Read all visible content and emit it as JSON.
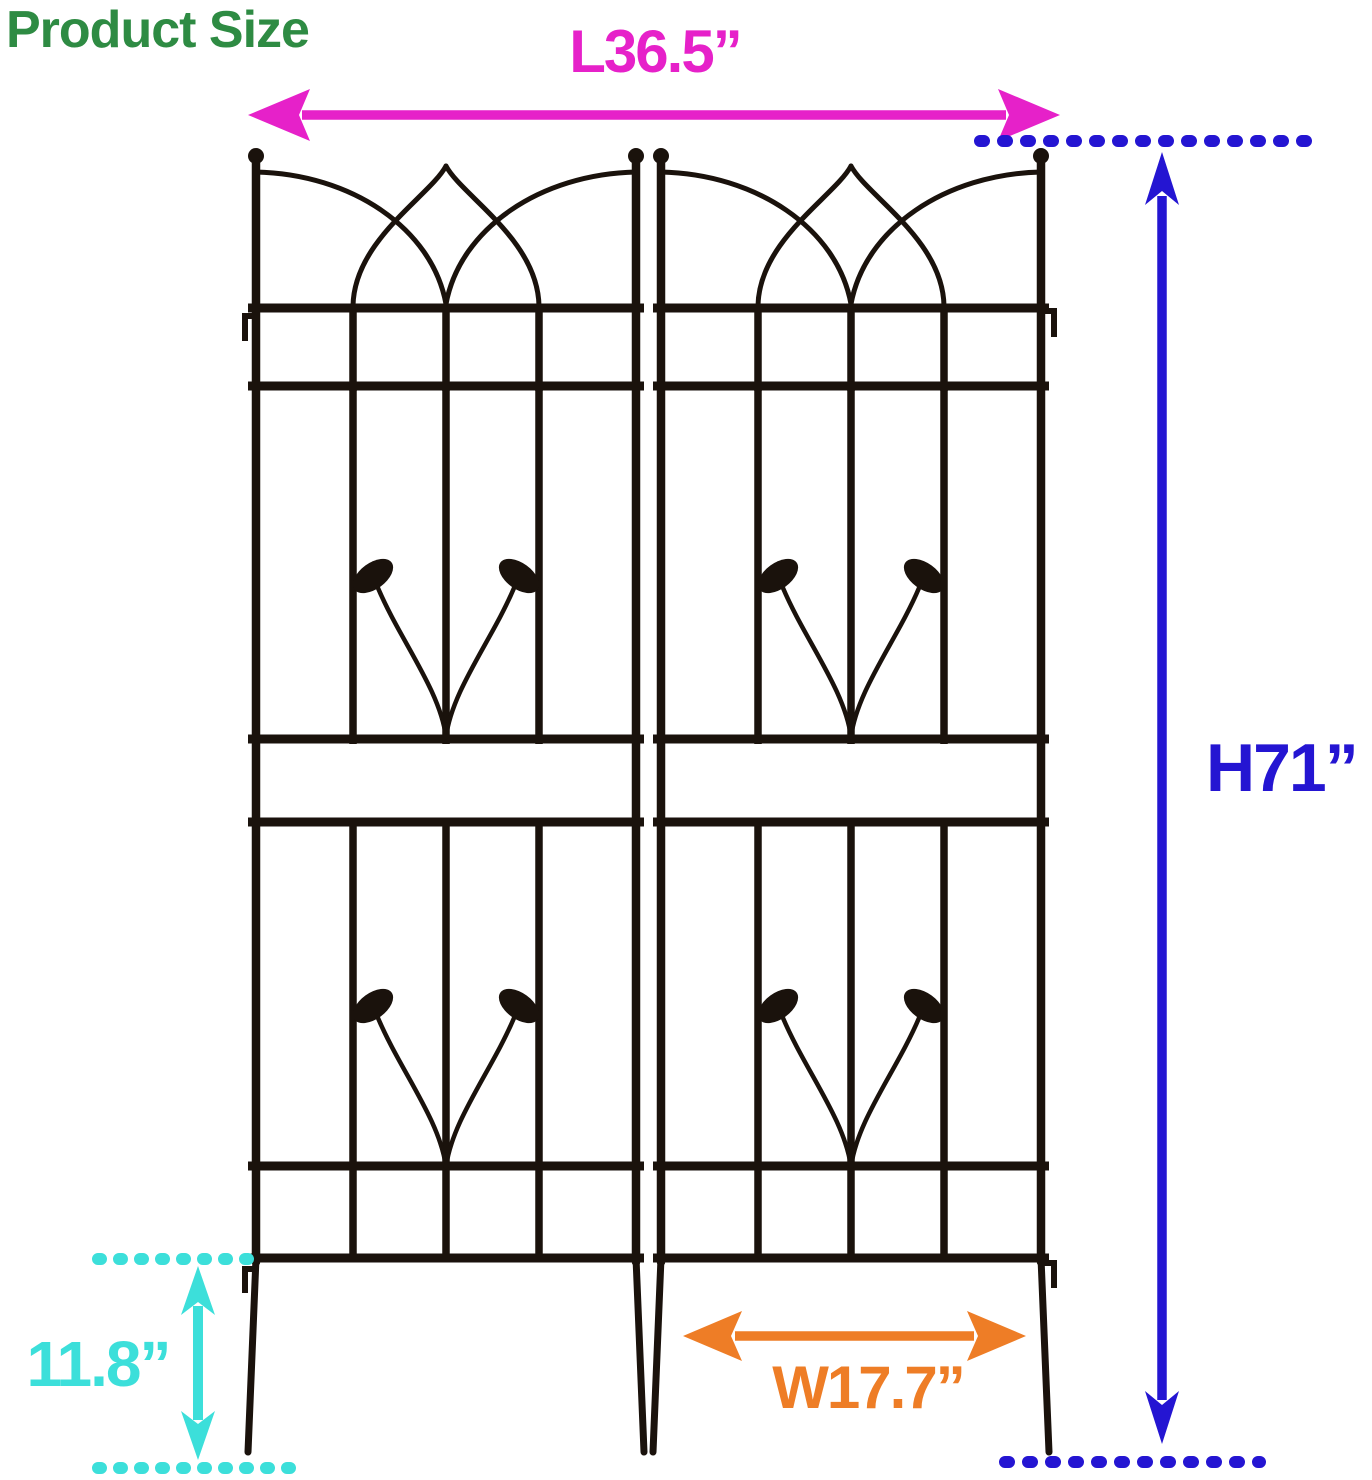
{
  "page": {
    "width": 1372,
    "height": 1480,
    "background": "#ffffff"
  },
  "title": {
    "text": "Product Size",
    "color": "#2e8b43"
  },
  "illustration": {
    "name": "metal-garden-trellis-two-panels",
    "panels": 2,
    "stroke_color": "#1a120c"
  },
  "dimensions": {
    "length": {
      "value": "L36.5”",
      "color": "#e621c9"
    },
    "height": {
      "value": "H71”",
      "color": "#2415d2"
    },
    "stake": {
      "value": "11.8”",
      "color": "#3cdfda"
    },
    "width": {
      "value": "W17.7”",
      "color": "#ee7d26"
    }
  }
}
